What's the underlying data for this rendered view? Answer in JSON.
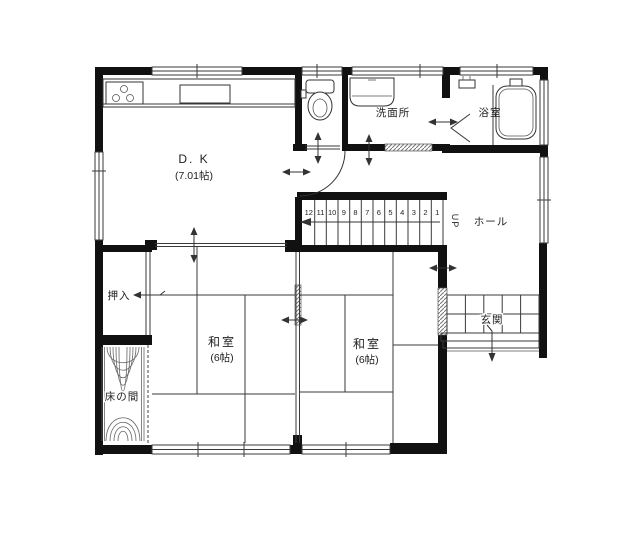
{
  "plan": {
    "rooms": {
      "dk": {
        "name": "D. K",
        "size": "(7.01帖)"
      },
      "washroom": {
        "name": "洗面所"
      },
      "bath": {
        "name": "浴室"
      },
      "hall": {
        "name": "ホール"
      },
      "closet": {
        "name": "押入"
      },
      "tokonoma": {
        "name": "床の間"
      },
      "tatami_left": {
        "name": "和室",
        "size": "(6帖)"
      },
      "tatami_right": {
        "name": "和室",
        "size": "(6帖)"
      },
      "entrance": {
        "name": "玄関"
      }
    },
    "stairs": {
      "direction": "UP",
      "steps": [
        "12",
        "11",
        "10",
        "9",
        "8",
        "7",
        "6",
        "5",
        "4",
        "3",
        "2",
        "1"
      ]
    },
    "colors": {
      "wall": "#111111",
      "line": "#3a3a3a",
      "text": "#222222",
      "bg": "#ffffff"
    }
  }
}
